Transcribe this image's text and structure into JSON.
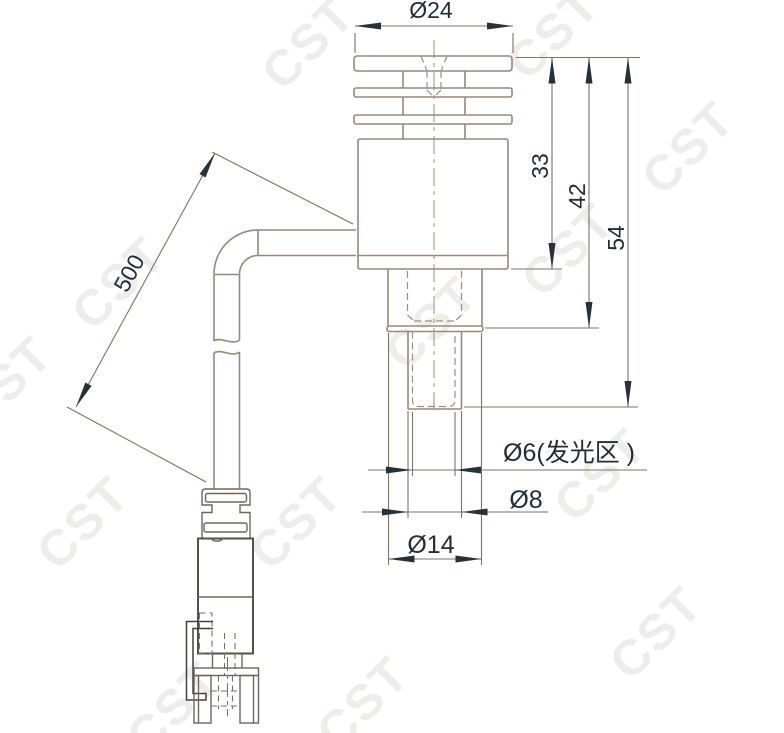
{
  "drawing": {
    "type": "engineering-dimension-drawing",
    "view": "side-view-led-lamp-with-cable-and-connector"
  },
  "watermark": {
    "text": "CST"
  },
  "dimensions": {
    "head_diameter": "Ø24",
    "body_length": "33",
    "length_to_step": "42",
    "overall_length": "54",
    "cable_length": "500",
    "emitting_area": "Ø6(发光区 )",
    "shaft_diameter": "Ø8",
    "step_diameter": "Ø14"
  },
  "colors": {
    "background": "#ffffff",
    "outline_line": "#97897b",
    "dimension_line": "#7e7366",
    "ink": "#26323a",
    "connector_line": "#6e665d",
    "watermark": "#ededf0"
  }
}
